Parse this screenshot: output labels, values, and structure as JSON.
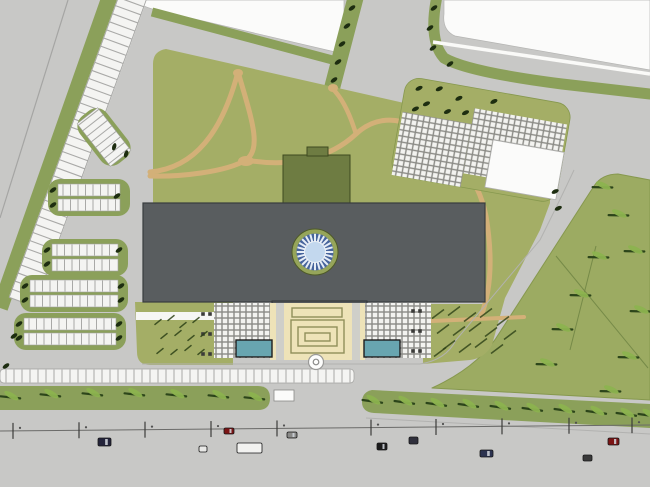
{
  "palette": {
    "road": "#c8c8c6",
    "parcel": "#fbfbfa",
    "verge": "#8ba05a",
    "lawn": "#a4ae66",
    "field": "#9cab62",
    "building": "#595d5f",
    "building_edge": "#383c3e",
    "canopy_dark": "#54585a",
    "wing": "#6e7c42",
    "wing_edge": "#3e4a20",
    "beige": "#eee3b8",
    "beige_line": "#8f8f5a",
    "pool": "#68a5b0",
    "pool_edge": "#1e1e1e",
    "tan": "#d3b078",
    "comb": "#f4f4f2",
    "comb_tick": "#a9a9a7",
    "comb_edge": "#a0a09e",
    "hatch_base": "#8b8b86",
    "hatch_sq": "#f3f3f0",
    "tree_dark": "#1d2d10",
    "tree_leaf": "#8cb34f",
    "tree_stem": "#2c451a",
    "shrub": "#2c4016",
    "dome_halo": "#96a55a",
    "dome_halo_edge": "#4e5a28",
    "dome_ring": "#46649c",
    "dome_spoke": "#e6edf6",
    "dome_center": "#c3d8ee",
    "gray_strip": "#cfcfc9",
    "bollard": "#3b3b39",
    "road_centerline": "#6b6b69",
    "tick": "#3c3c3a",
    "field_line": "#768a48",
    "boundary_line": "#a5a5a3"
  },
  "dome": {
    "cx": 315,
    "cy": 252,
    "spokes": 24,
    "r_halo": 23,
    "r_ring": 18.5,
    "r_center": 10.5
  },
  "trees": {
    "dark": [
      [
        352,
        8
      ],
      [
        347,
        26
      ],
      [
        342,
        44
      ],
      [
        338,
        62
      ],
      [
        334,
        80
      ],
      [
        434,
        8
      ],
      [
        430,
        28
      ],
      [
        433,
        48
      ],
      [
        450,
        64
      ],
      [
        14,
        336
      ],
      [
        6,
        366
      ]
    ],
    "zone_local": [
      [
        14,
        10
      ],
      [
        34,
        7
      ],
      [
        55,
        13
      ],
      [
        24,
        24
      ],
      [
        46,
        28
      ],
      [
        14,
        31
      ],
      [
        64,
        26
      ],
      [
        90,
        10
      ],
      [
        166,
        88
      ],
      [
        172,
        104
      ]
    ],
    "leaf": [
      [
        10,
        396,
        30
      ],
      [
        50,
        394,
        30
      ],
      [
        92,
        393,
        30
      ],
      [
        134,
        393,
        30
      ],
      [
        176,
        394,
        30
      ],
      [
        218,
        395,
        30
      ],
      [
        254,
        397,
        30
      ],
      [
        372,
        400,
        32
      ],
      [
        404,
        401,
        32
      ],
      [
        436,
        403,
        32
      ],
      [
        468,
        404,
        32
      ],
      [
        500,
        406,
        32
      ],
      [
        532,
        408,
        32
      ],
      [
        564,
        409,
        32
      ],
      [
        596,
        411,
        32
      ],
      [
        626,
        413,
        32
      ],
      [
        648,
        414,
        32
      ],
      [
        602,
        186,
        25
      ],
      [
        618,
        214,
        25
      ],
      [
        598,
        256,
        25
      ],
      [
        580,
        294,
        25
      ],
      [
        562,
        328,
        25
      ],
      [
        546,
        363,
        25
      ],
      [
        634,
        250,
        25
      ],
      [
        640,
        310,
        25
      ],
      [
        628,
        356,
        25
      ],
      [
        610,
        390,
        25
      ]
    ]
  },
  "parking": {
    "long_row": {
      "x1": 134,
      "y1": -6,
      "x2": 22,
      "y2": 302,
      "width": 28,
      "stalls": 38
    },
    "street_row": {
      "x": 0,
      "y": 369,
      "w": 354,
      "h": 14,
      "step": 8
    },
    "tilted_bay": {
      "cx": 104,
      "cy": 137,
      "rot": -38,
      "trees": [
        [
          2,
          14
        ],
        [
          7,
          27
        ]
      ]
    },
    "bays": [
      {
        "x": 58,
        "y": 184,
        "w": 62,
        "trees": [
          [
            53,
            190
          ],
          [
            53,
            205
          ],
          [
            117,
            196
          ]
        ]
      },
      {
        "x": 52,
        "y": 244,
        "w": 66,
        "trees": [
          [
            47,
            250
          ],
          [
            47,
            264
          ],
          [
            119,
            250
          ]
        ]
      },
      {
        "x": 30,
        "y": 280,
        "w": 88,
        "trees": [
          [
            25,
            286
          ],
          [
            25,
            300
          ],
          [
            121,
            286
          ],
          [
            121,
            300
          ]
        ]
      },
      {
        "x": 24,
        "y": 318,
        "w": 92,
        "trees": [
          [
            19,
            324
          ],
          [
            19,
            338
          ],
          [
            119,
            324
          ],
          [
            119,
            338
          ]
        ]
      }
    ]
  },
  "shrubs": {
    "left": [
      [
        158,
        322
      ],
      [
        171,
        318
      ],
      [
        183,
        325
      ],
      [
        196,
        320
      ],
      [
        164,
        336
      ],
      [
        178,
        333
      ],
      [
        191,
        338
      ],
      [
        204,
        334
      ],
      [
        160,
        351
      ],
      [
        174,
        352
      ],
      [
        188,
        348
      ],
      [
        201,
        352
      ]
    ],
    "right": [
      [
        438,
        314
      ],
      [
        454,
        311
      ],
      [
        470,
        317
      ],
      [
        486,
        313
      ],
      [
        443,
        329
      ],
      [
        459,
        331
      ],
      [
        475,
        327
      ],
      [
        491,
        332
      ],
      [
        449,
        345
      ],
      [
        465,
        348
      ],
      [
        481,
        343
      ],
      [
        497,
        349
      ],
      [
        503,
        321
      ],
      [
        440,
        352
      ],
      [
        510,
        335
      ]
    ]
  },
  "bollards": [
    [
      203,
      314
    ],
    [
      210,
      314
    ],
    [
      203,
      334
    ],
    [
      210,
      334
    ],
    [
      203,
      354
    ],
    [
      210,
      354
    ],
    [
      413,
      311
    ],
    [
      420,
      311
    ],
    [
      413,
      331
    ],
    [
      420,
      331
    ],
    [
      413,
      351
    ],
    [
      420,
      351
    ]
  ],
  "road": {
    "centerline": {
      "x1": 0,
      "y1": 431,
      "x2": 650,
      "y2": 425
    },
    "ticks": [
      13,
      79,
      145,
      211,
      277,
      371,
      436,
      502,
      569,
      632
    ],
    "bus_stop": {
      "x": 274,
      "y": 390,
      "w": 20,
      "h": 11
    }
  },
  "cars": [
    {
      "x": 98,
      "y": 438,
      "w": 13,
      "h": 8,
      "c": "#23233a"
    },
    {
      "x": 224,
      "y": 428,
      "w": 10,
      "h": 6,
      "c": "#7c1414"
    },
    {
      "x": 199,
      "y": 446,
      "w": 8,
      "h": 6,
      "c": "#e8e8e6"
    },
    {
      "x": 237,
      "y": 443,
      "w": 25,
      "h": 10,
      "c": "#f2f2f0"
    },
    {
      "x": 287,
      "y": 432,
      "w": 10,
      "h": 6,
      "c": "#8a8a88"
    },
    {
      "x": 377,
      "y": 443,
      "w": 10,
      "h": 7,
      "c": "#1c1c1c"
    },
    {
      "x": 409,
      "y": 437,
      "w": 9,
      "h": 7,
      "c": "#30303c"
    },
    {
      "x": 480,
      "y": 450,
      "w": 13,
      "h": 7,
      "c": "#2c3350"
    },
    {
      "x": 583,
      "y": 455,
      "w": 9,
      "h": 6,
      "c": "#3a3a3a"
    },
    {
      "x": 608,
      "y": 438,
      "w": 11,
      "h": 7,
      "c": "#7c1414"
    }
  ],
  "field_lines": [
    [
      556,
      256,
      648,
      368
    ],
    [
      596,
      246,
      570,
      350
    ]
  ]
}
